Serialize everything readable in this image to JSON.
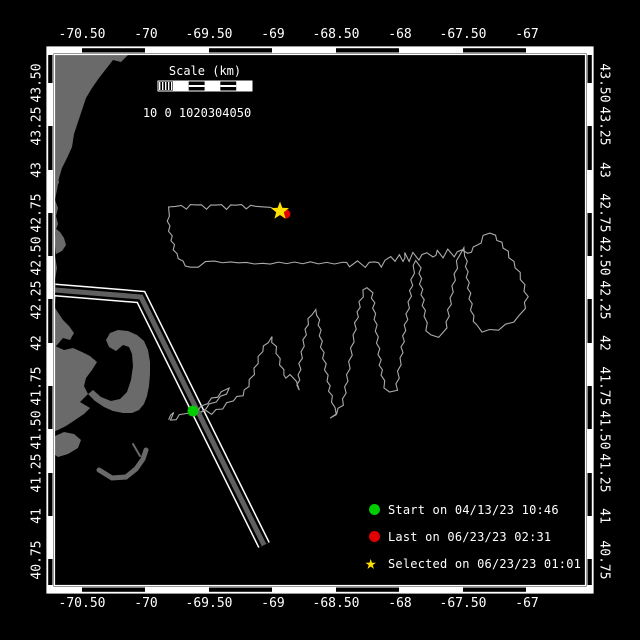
{
  "map": {
    "bg": "#000000",
    "frame_color": "#ffffff",
    "coast_color": "#6a6a6a",
    "track_color": "#ababab",
    "plot": {
      "x": 55,
      "y": 55,
      "w": 530,
      "h": 530
    },
    "band_black_x": [
      [
        82,
        145
      ],
      [
        209,
        272
      ],
      [
        336,
        399
      ],
      [
        463,
        526
      ]
    ],
    "band_black_y": [
      [
        55,
        83
      ],
      [
        126,
        170
      ],
      [
        213,
        256
      ],
      [
        299,
        343
      ],
      [
        386,
        429
      ],
      [
        473,
        516
      ],
      [
        559,
        585
      ]
    ],
    "lon_ticks": [
      {
        "label": "-70.50",
        "x": 82
      },
      {
        "label": "-70",
        "x": 146
      },
      {
        "label": "-69.50",
        "x": 209
      },
      {
        "label": "-69",
        "x": 273
      },
      {
        "label": "-68.50",
        "x": 336
      },
      {
        "label": "-68",
        "x": 400
      },
      {
        "label": "-67.50",
        "x": 463
      },
      {
        "label": "-67",
        "x": 527
      }
    ],
    "lat_ticks": [
      {
        "label": "43.50",
        "y": 83
      },
      {
        "label": "43.25",
        "y": 126
      },
      {
        "label": "43",
        "y": 170
      },
      {
        "label": "42.75",
        "y": 213
      },
      {
        "label": "42.50",
        "y": 256
      },
      {
        "label": "42.25",
        "y": 300
      },
      {
        "label": "42",
        "y": 343
      },
      {
        "label": "41.75",
        "y": 386
      },
      {
        "label": "41.50",
        "y": 430
      },
      {
        "label": "41.25",
        "y": 473
      },
      {
        "label": "41",
        "y": 516
      },
      {
        "label": "40.75",
        "y": 560
      }
    ],
    "coast_polys": [
      [
        [
          55,
          55
        ],
        [
          128,
          55
        ],
        [
          121,
          62
        ],
        [
          113,
          60
        ],
        [
          106,
          69
        ],
        [
          99,
          78
        ],
        [
          92,
          88
        ],
        [
          86,
          98
        ],
        [
          82,
          110
        ],
        [
          78,
          122
        ],
        [
          74,
          134
        ],
        [
          72,
          147
        ],
        [
          67,
          158
        ],
        [
          62,
          168
        ],
        [
          59,
          178
        ],
        [
          57,
          190
        ],
        [
          55,
          200
        ]
      ],
      [
        [
          55,
          200
        ],
        [
          58,
          208
        ],
        [
          56,
          216
        ],
        [
          58,
          224
        ],
        [
          55,
          232
        ],
        [
          56,
          244
        ],
        [
          55,
          256
        ],
        [
          57,
          268
        ],
        [
          55,
          280
        ],
        [
          56,
          292
        ],
        [
          55,
          304
        ]
      ],
      [
        [
          55,
          228
        ],
        [
          60,
          232
        ],
        [
          64,
          238
        ],
        [
          66,
          245
        ],
        [
          62,
          251
        ],
        [
          56,
          254
        ]
      ],
      [
        [
          55,
          308
        ],
        [
          59,
          314
        ],
        [
          63,
          320
        ],
        [
          69,
          326
        ],
        [
          74,
          333
        ],
        [
          70,
          340
        ],
        [
          63,
          338
        ],
        [
          57,
          345
        ],
        [
          55,
          347
        ]
      ],
      [
        [
          55,
          346
        ],
        [
          64,
          350
        ],
        [
          73,
          348
        ],
        [
          82,
          352
        ],
        [
          90,
          356
        ],
        [
          97,
          362
        ],
        [
          92,
          370
        ],
        [
          86,
          378
        ],
        [
          84,
          386
        ],
        [
          88,
          394
        ],
        [
          95,
          401
        ],
        [
          104,
          407
        ],
        [
          113,
          411
        ],
        [
          123,
          413
        ],
        [
          132,
          413
        ],
        [
          139,
          410
        ],
        [
          144,
          404
        ],
        [
          147,
          396
        ],
        [
          149,
          386
        ],
        [
          150,
          374
        ],
        [
          150,
          362
        ],
        [
          148,
          350
        ],
        [
          144,
          341
        ],
        [
          137,
          335
        ],
        [
          128,
          331
        ],
        [
          118,
          330
        ],
        [
          110,
          333
        ],
        [
          106,
          340
        ],
        [
          109,
          347
        ],
        [
          116,
          351
        ],
        [
          123,
          345
        ],
        [
          129,
          347
        ],
        [
          132,
          354
        ],
        [
          133,
          366
        ],
        [
          131,
          380
        ],
        [
          127,
          392
        ],
        [
          120,
          399
        ],
        [
          111,
          401
        ],
        [
          101,
          397
        ],
        [
          93,
          390
        ],
        [
          87,
          395
        ],
        [
          80,
          402
        ],
        [
          90,
          408
        ],
        [
          84,
          414
        ],
        [
          75,
          420
        ],
        [
          66,
          426
        ],
        [
          58,
          430
        ],
        [
          55,
          431
        ]
      ],
      [
        [
          55,
          436
        ],
        [
          64,
          432
        ],
        [
          74,
          434
        ],
        [
          81,
          440
        ],
        [
          78,
          448
        ],
        [
          68,
          454
        ],
        [
          58,
          457
        ],
        [
          55,
          455
        ]
      ]
    ],
    "coast_islets": [
      {
        "x": 63,
        "y": 146,
        "r": 2.2
      },
      {
        "x": 57,
        "y": 182,
        "r": 2.0
      }
    ],
    "coast_strokes": [
      {
        "path": [
          [
            99,
            470
          ],
          [
            112,
            478
          ],
          [
            126,
            477
          ],
          [
            136,
            469
          ],
          [
            143,
            459
          ],
          [
            146,
            450
          ]
        ],
        "w": 5
      },
      {
        "path": [
          [
            133,
            444
          ],
          [
            140,
            456
          ]
        ],
        "w": 2
      }
    ],
    "lane": {
      "edge": "#ffffff",
      "gap": "#000000",
      "center": "#5f5f5f",
      "path": [
        [
          55,
          290
        ],
        [
          141,
          297
        ],
        [
          264,
          545
        ]
      ]
    },
    "track_points": [
      [
        168,
        419
      ],
      [
        175,
        413
      ],
      [
        171,
        421
      ],
      [
        180,
        416
      ],
      [
        188,
        412
      ],
      [
        193,
        411
      ],
      [
        202,
        407
      ],
      [
        212,
        399
      ],
      [
        222,
        393
      ],
      [
        230,
        389
      ],
      [
        221,
        397
      ],
      [
        210,
        405
      ],
      [
        201,
        411
      ],
      [
        211,
        413
      ],
      [
        222,
        408
      ],
      [
        233,
        400
      ],
      [
        242,
        395
      ],
      [
        248,
        386
      ],
      [
        253,
        374
      ],
      [
        257,
        363
      ],
      [
        262,
        351
      ],
      [
        267,
        342
      ],
      [
        271,
        337
      ],
      [
        275,
        347
      ],
      [
        279,
        359
      ],
      [
        283,
        370
      ],
      [
        287,
        379
      ],
      [
        291,
        374
      ],
      [
        295,
        382
      ],
      [
        298,
        390
      ],
      [
        299,
        375
      ],
      [
        301,
        358
      ],
      [
        304,
        340
      ],
      [
        307,
        324
      ],
      [
        311,
        314
      ],
      [
        315,
        310
      ],
      [
        318,
        315
      ],
      [
        320,
        330
      ],
      [
        322,
        347
      ],
      [
        325,
        364
      ],
      [
        328,
        381
      ],
      [
        331,
        396
      ],
      [
        334,
        408
      ],
      [
        337,
        416
      ],
      [
        331,
        419
      ],
      [
        336,
        413
      ],
      [
        342,
        405
      ],
      [
        345,
        393
      ],
      [
        348,
        375
      ],
      [
        351,
        355
      ],
      [
        354,
        335
      ],
      [
        357,
        317
      ],
      [
        360,
        302
      ],
      [
        364,
        291
      ],
      [
        368,
        287
      ],
      [
        372,
        293
      ],
      [
        374,
        308
      ],
      [
        376,
        325
      ],
      [
        378,
        343
      ],
      [
        380,
        360
      ],
      [
        382,
        375
      ],
      [
        385,
        387
      ],
      [
        390,
        393
      ],
      [
        396,
        390
      ],
      [
        398,
        378
      ],
      [
        401,
        358
      ],
      [
        404,
        336
      ],
      [
        407,
        314
      ],
      [
        410,
        296
      ],
      [
        412,
        280
      ],
      [
        414,
        266
      ],
      [
        417,
        260
      ],
      [
        420,
        268
      ],
      [
        421,
        284
      ],
      [
        423,
        300
      ],
      [
        425,
        316
      ],
      [
        427,
        330
      ],
      [
        431,
        336
      ],
      [
        438,
        336
      ],
      [
        444,
        333
      ],
      [
        447,
        322
      ],
      [
        450,
        304
      ],
      [
        453,
        286
      ],
      [
        456,
        268
      ],
      [
        459,
        254
      ],
      [
        463,
        248
      ],
      [
        466,
        256
      ],
      [
        467,
        272
      ],
      [
        469,
        288
      ],
      [
        471,
        304
      ],
      [
        473,
        316
      ],
      [
        476,
        326
      ],
      [
        482,
        331
      ],
      [
        490,
        331
      ],
      [
        498,
        329
      ],
      [
        506,
        325
      ],
      [
        513,
        321
      ],
      [
        520,
        316
      ],
      [
        524,
        308
      ],
      [
        527,
        297
      ],
      [
        524,
        285
      ],
      [
        519,
        273
      ],
      [
        513,
        262
      ],
      [
        507,
        252
      ],
      [
        501,
        243
      ],
      [
        495,
        236
      ],
      [
        489,
        232
      ],
      [
        484,
        236
      ],
      [
        480,
        242
      ],
      [
        474,
        248
      ],
      [
        467,
        254
      ],
      [
        461,
        249
      ],
      [
        455,
        256
      ],
      [
        449,
        250
      ],
      [
        444,
        257
      ],
      [
        438,
        251
      ],
      [
        432,
        258
      ],
      [
        426,
        252
      ],
      [
        420,
        259
      ],
      [
        414,
        253
      ],
      [
        410,
        261
      ],
      [
        406,
        253
      ],
      [
        402,
        262
      ],
      [
        398,
        254
      ],
      [
        394,
        262
      ],
      [
        390,
        256
      ],
      [
        382,
        266
      ],
      [
        374,
        261
      ],
      [
        366,
        266
      ],
      [
        358,
        262
      ],
      [
        350,
        266
      ],
      [
        342,
        261
      ],
      [
        334,
        265
      ],
      [
        326,
        261
      ],
      [
        318,
        265
      ],
      [
        310,
        261
      ],
      [
        302,
        265
      ],
      [
        294,
        261
      ],
      [
        286,
        265
      ],
      [
        278,
        261
      ],
      [
        270,
        265
      ],
      [
        262,
        262
      ],
      [
        254,
        265
      ],
      [
        246,
        261
      ],
      [
        238,
        264
      ],
      [
        230,
        261
      ],
      [
        222,
        264
      ],
      [
        214,
        260
      ],
      [
        206,
        263
      ],
      [
        198,
        266
      ],
      [
        190,
        268
      ],
      [
        182,
        262
      ],
      [
        176,
        254
      ],
      [
        173,
        245
      ],
      [
        171,
        236
      ],
      [
        169,
        226
      ],
      [
        168,
        216
      ],
      [
        169,
        208
      ],
      [
        176,
        205
      ],
      [
        186,
        208
      ],
      [
        196,
        204
      ],
      [
        206,
        208
      ],
      [
        216,
        204
      ],
      [
        226,
        208
      ],
      [
        236,
        204
      ],
      [
        246,
        208
      ],
      [
        256,
        205
      ],
      [
        264,
        208
      ],
      [
        271,
        206
      ],
      [
        277,
        210
      ]
    ],
    "markers": {
      "start": {
        "x": 193,
        "y": 411,
        "r": 5.5,
        "color": "#00cc00"
      },
      "last": {
        "x": 286,
        "y": 214,
        "r": 4.5,
        "color": "#e00000"
      },
      "selected": {
        "x": 280,
        "y": 211,
        "r": 9.5,
        "color": "#ffe000"
      }
    }
  },
  "scale_bar": {
    "title": "Scale (km)",
    "numbers": "10 0 1020304050",
    "x": 158,
    "y": 81,
    "w": 94,
    "h": 10,
    "title_cx": 205,
    "title_cy": 64,
    "numbers_cx": 197,
    "numbers_cy": 106
  },
  "legend": {
    "items": [
      {
        "marker": "circle",
        "color": "#00cc00",
        "label": "Start on 04/13/23 10:46"
      },
      {
        "marker": "circle",
        "color": "#e00000",
        "label": "Last on 06/23/23 02:31"
      },
      {
        "marker": "star",
        "color": "#ffe000",
        "label": "Selected on 06/23/23 01:01"
      }
    ],
    "star_glyph": "★"
  }
}
